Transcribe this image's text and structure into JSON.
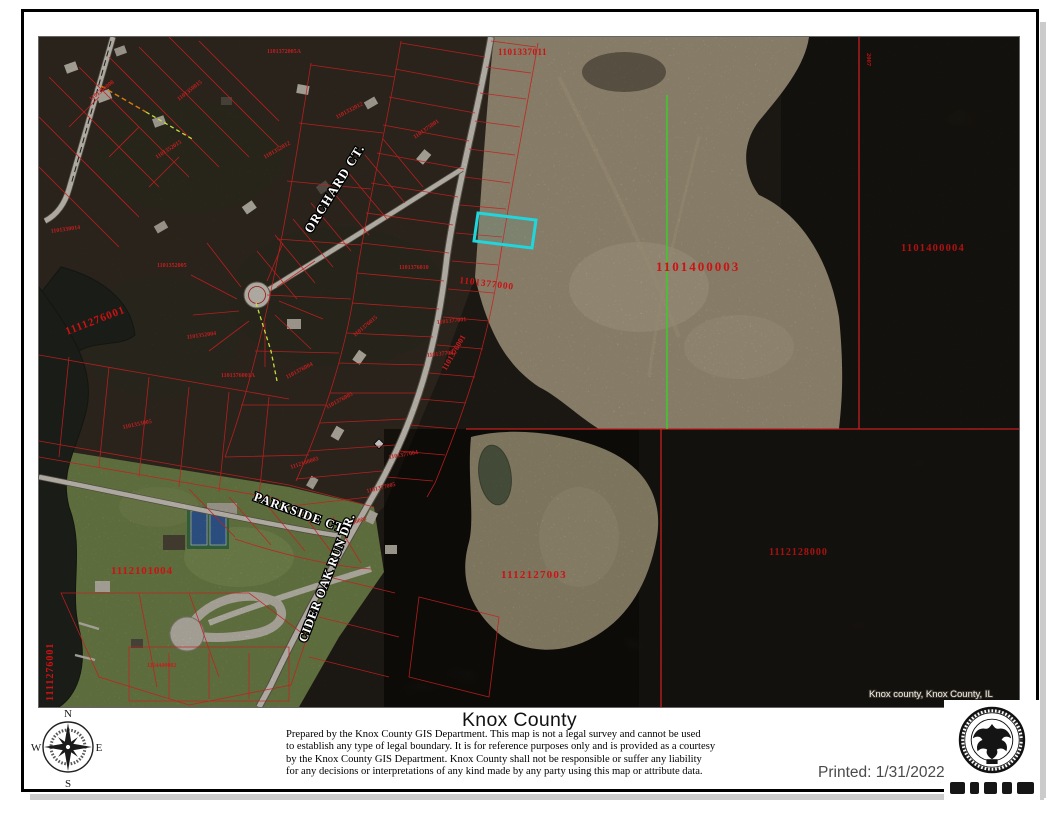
{
  "map": {
    "selected_parcel_color": "#20d6dc",
    "parcel_line_color": "#c41f1f",
    "survey_line_color": "#3ecb29",
    "street_labels": [
      {
        "text": "ORCHARD CT."
      },
      {
        "text": "PARKSIDE CT."
      },
      {
        "text": "CIDER OAK RUN DR."
      }
    ],
    "parcel_labels": [
      {
        "text": "1101337011"
      },
      {
        "text": "1101400003"
      },
      {
        "text": "1101400004"
      },
      {
        "text": "1101377000"
      },
      {
        "text": "1112127003"
      },
      {
        "text": "1112128000"
      },
      {
        "text": "1111276001"
      },
      {
        "text": "1111276001"
      },
      {
        "text": "1112101004"
      },
      {
        "text": "2007"
      }
    ],
    "small_parcel_labels": [
      "1101372005A",
      "1101352015",
      "1101350008",
      "1101330014",
      "1101352005",
      "1101352004",
      "1101376001A",
      "1101353005",
      "1101376004",
      "1101376005",
      "1101376015",
      "1101352012",
      "1101332012",
      "1101375001",
      "1101376010",
      "1101377001",
      "1101377002",
      "1101376001",
      "1101377004",
      "1101377005",
      "1112100002",
      "1112100003",
      "1114400002",
      "1101350015"
    ],
    "attribution": "Knox county, Knox County, IL"
  },
  "footer": {
    "title": "Knox County",
    "disclaimer_lines": [
      "Prepared by the Knox County GIS Department. This map is not a legal survey and cannot be used",
      "to establish any type of legal boundary. It is for reference purposes only and is provided as a courtesy",
      "by the Knox County GIS Department.  Knox County shall not be responsible or suffer any liability",
      "for any decisions or interpretations of any kind made by any party using this map or attribute data."
    ],
    "printed": "Printed: 1/31/2022",
    "compass": {
      "north": "N",
      "south": "S",
      "east": "E",
      "west": "W"
    }
  }
}
